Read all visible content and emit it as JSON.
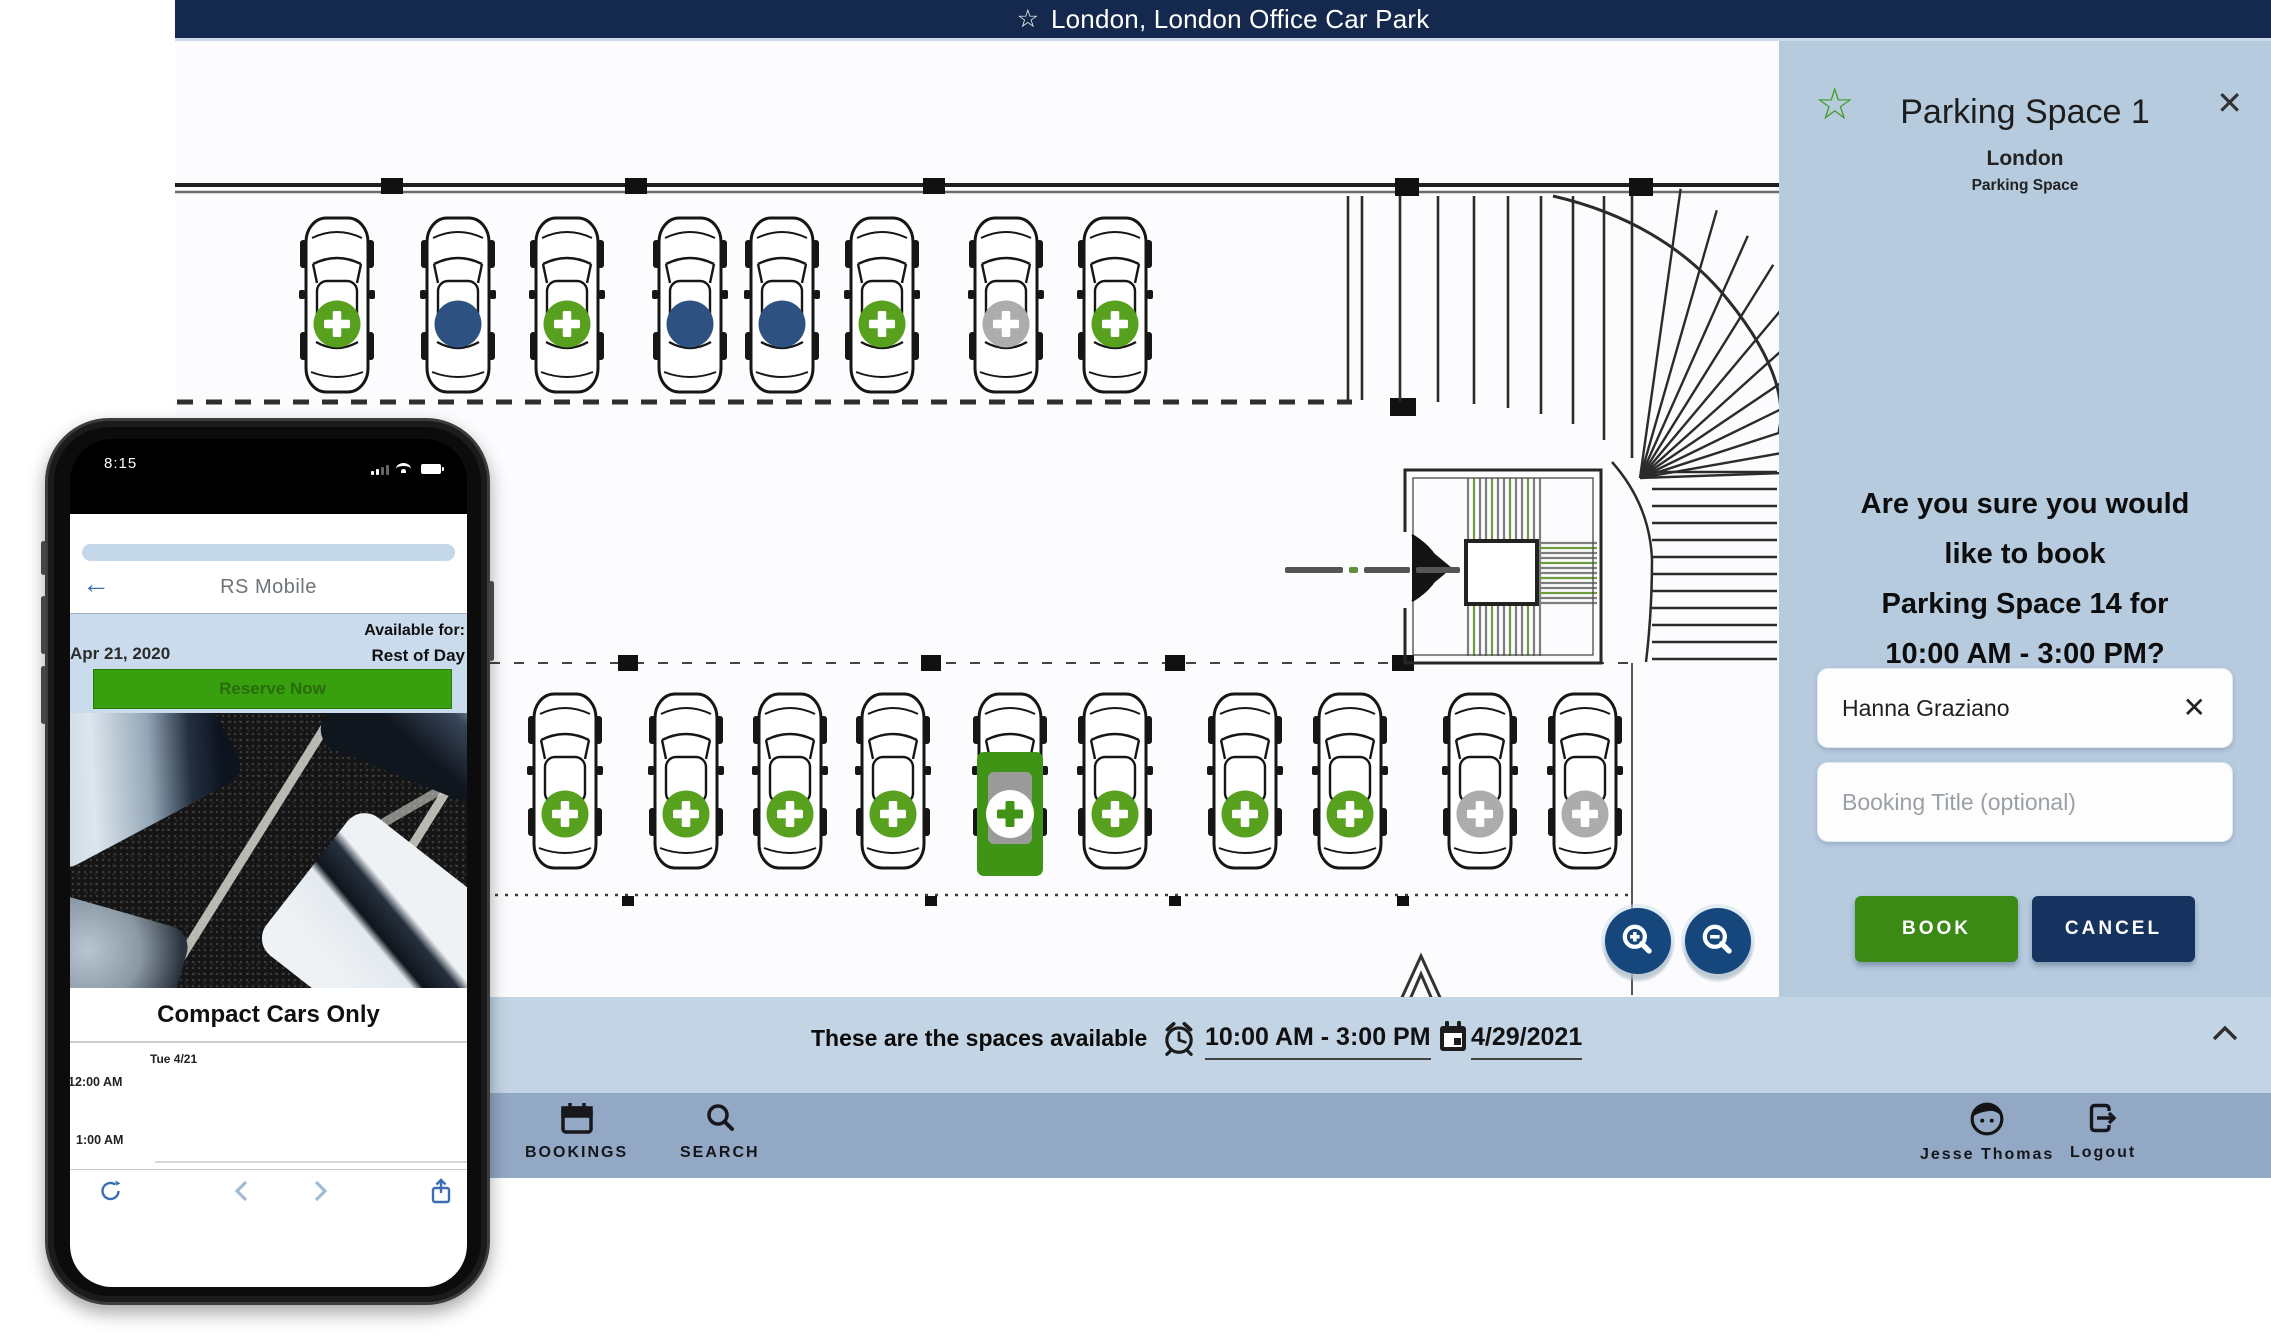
{
  "top_bar": {
    "title": "London, London Office Car Park"
  },
  "panel": {
    "title": "Parking Space 1",
    "location": "London",
    "type_label": "Parking Space",
    "confirm_lines": [
      "Are you sure you would",
      "like to book",
      "Parking Space 14 for",
      "10:00 AM - 3:00 PM?"
    ],
    "attendee": "Hanna Graziano",
    "booking_title_placeholder": "Booking Title (optional)",
    "book_label": "BOOK",
    "cancel_label": "CANCEL"
  },
  "bottom_sheet": {
    "label": "These are the spaces available",
    "time_range": "10:00 AM - 3:00 PM",
    "date": "4/29/2021"
  },
  "nav": {
    "bookings": "BOOKINGS",
    "search": "SEARCH",
    "user": "Jesse Thomas",
    "logout": "Logout"
  },
  "phone": {
    "status_time": "8:15",
    "app_title": "RS Mobile",
    "date": "Apr 21, 2020",
    "available_label": "Available for:",
    "available_value": "Rest of Day",
    "reserve_label": "Reserve Now",
    "caption": "Compact Cars Only",
    "day_label": "Tue 4/21",
    "times": [
      "12:00 AM",
      "1:00 AM"
    ]
  },
  "map": {
    "top_row": [
      "available",
      "booked",
      "available",
      "booked",
      "booked",
      "available",
      "unavailable",
      "available"
    ],
    "bottom_row": [
      "available",
      "available",
      "available",
      "available",
      "selected",
      "available",
      "available",
      "available",
      "unavailable",
      "unavailable"
    ]
  },
  "colors": {
    "brand_navy": "#14294d",
    "panel_bg": "#b7cbdf",
    "available_green": "#58a11f",
    "selected_green": "#3f9416",
    "booked_navy": "#2d5181",
    "unavailable_gray": "#acacac",
    "book_green": "#3b8a15",
    "cancel_navy": "#16325f"
  }
}
